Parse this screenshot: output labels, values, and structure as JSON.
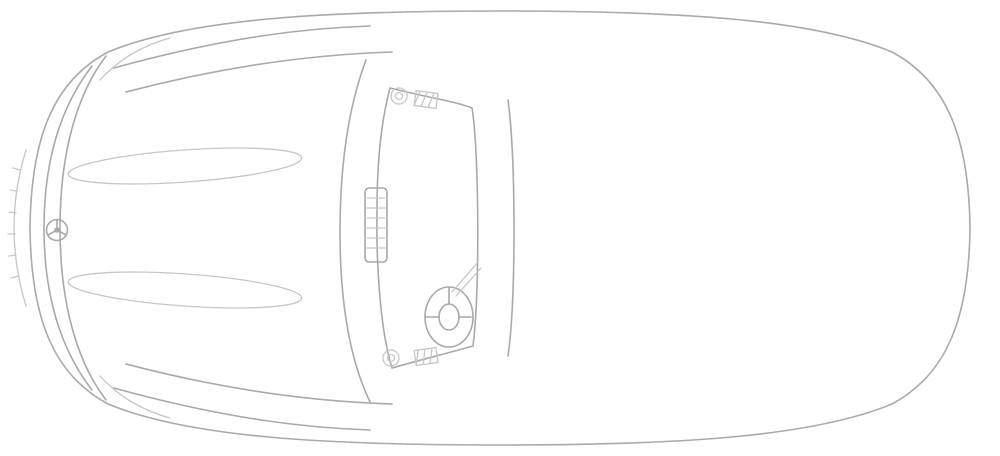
{
  "diagram": {
    "kind": "vehicle-component-location-top-view",
    "vehicle_front": "left",
    "canvas": {
      "width": 1000,
      "height": 456
    }
  },
  "colors": {
    "background": "#ffffff",
    "outline_gray": "#a9a9a9",
    "outline_light": "#c6c6c6",
    "hotspot_red": "#e81515",
    "seal_teal": "#17807c",
    "insulation_dark_red": "#8a0808",
    "component_blue": "#5353d9",
    "component_green": "#2fd32f",
    "component_purple": "#983898",
    "label_yellow": "#f2f20c",
    "glyph_black": "#141414"
  },
  "hotspots": {
    "green_antenna_boxes": [
      {
        "id": "front-upper",
        "x": 266,
        "y": 77
      },
      {
        "id": "front-lower",
        "x": 267,
        "y": 374
      },
      {
        "id": "rear-upper",
        "x": 886,
        "y": 101
      },
      {
        "id": "rear-lower",
        "x": 886,
        "y": 355
      }
    ],
    "blue_antenna_boxes": [
      {
        "id": "cowl-upper",
        "x": 441,
        "y": 71
      },
      {
        "id": "cowl-lower",
        "x": 439,
        "y": 383
      }
    ],
    "purple_module_boxes": [
      {
        "id": "rear-upper-left",
        "x": 651,
        "y": 77
      },
      {
        "id": "rear-upper-right",
        "x": 738,
        "y": 116
      },
      {
        "id": "rear-lower-right",
        "x": 738,
        "y": 342
      },
      {
        "id": "rear-lower-left",
        "x": 648,
        "y": 376
      }
    ],
    "green_bracket_boxes": [
      {
        "id": "rear-bracket-upper",
        "x": 742,
        "y": 168
      },
      {
        "id": "rear-bracket-lower",
        "x": 742,
        "y": 289
      }
    ]
  },
  "overlays": {
    "windshield_seal_bands": 2,
    "sound_insulation_blob": {
      "x_range": [
        626,
        742
      ],
      "y_range": [
        36,
        362
      ]
    },
    "blue_pads": [
      {
        "id": "dash-pad-pair",
        "x": 411,
        "y": 147
      },
      {
        "id": "footwell-left",
        "x": 406,
        "y": 314
      },
      {
        "id": "footwell-right",
        "x": 475,
        "y": 314
      },
      {
        "id": "rear-shelf-upper-left",
        "x": 607,
        "y": 97
      },
      {
        "id": "rear-shelf-upper-right",
        "x": 694,
        "y": 109
      },
      {
        "id": "rear-shelf-lower-left",
        "x": 605,
        "y": 354
      },
      {
        "id": "rear-shelf-lower-right",
        "x": 694,
        "y": 352
      }
    ],
    "blue_door_strips": [
      {
        "id": "door-strip-upper",
        "x": 546,
        "y": 69
      },
      {
        "id": "door-strip-lower",
        "x": 545,
        "y": 384
      }
    ]
  },
  "labels": {
    "spec_labels": [
      {
        "id": "spec-label-front",
        "x": 307,
        "y": 116,
        "rows": 2,
        "holes_per_row": 4
      },
      {
        "id": "spec-label-rear",
        "x": 871,
        "y": 212,
        "rows": 2,
        "holes_per_row": 4
      }
    ],
    "heater_icon": {
      "id": "electric-heater-icon",
      "x": 442,
      "y": 227
    },
    "hood_open_icons": [
      {
        "id": "hood-open-icon-upper",
        "x": 339,
        "y": 51
      },
      {
        "id": "hood-open-icon-lower",
        "x": 339,
        "y": 406
      }
    ]
  },
  "arrows": [
    {
      "id": "spec-label-arrow-front",
      "x": 310,
      "from_y": 456,
      "to_y": 142
    },
    {
      "id": "spec-label-arrow-rear",
      "x": 862,
      "from_y": 456,
      "to_y": 243
    }
  ]
}
